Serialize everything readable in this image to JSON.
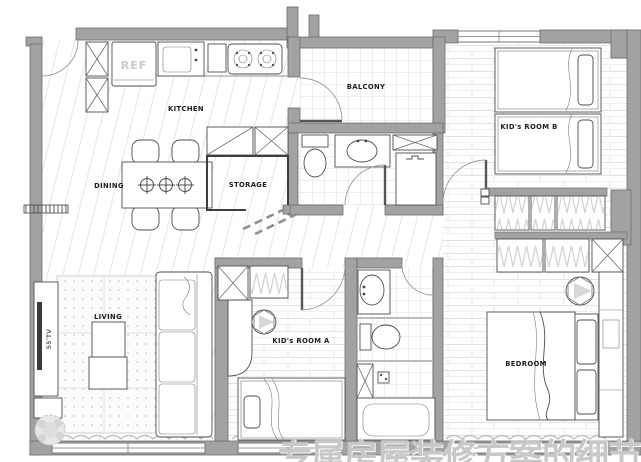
{
  "plan": {
    "labels": {
      "kitchen": "KITCHEN",
      "dining": "DINING",
      "storage": "STORAGE",
      "balcony": "BALCONY",
      "kids_room_b": "KID's ROOM B",
      "kids_room_a": "KID's ROOM A",
      "bedroom": "BEDROOM",
      "living": "LIVING",
      "ref": "REF",
      "tv": "55'TV"
    },
    "watermark": "专属房屋装修方案的细节空间",
    "colors": {
      "wall": "#a2a2a2",
      "wall_edge": "#6e6e6e",
      "furniture_line": "#4e4e4e",
      "floor_line": "#e4e4e4",
      "label": "#1c1c1c",
      "watermark": "#b9b9b9"
    }
  }
}
